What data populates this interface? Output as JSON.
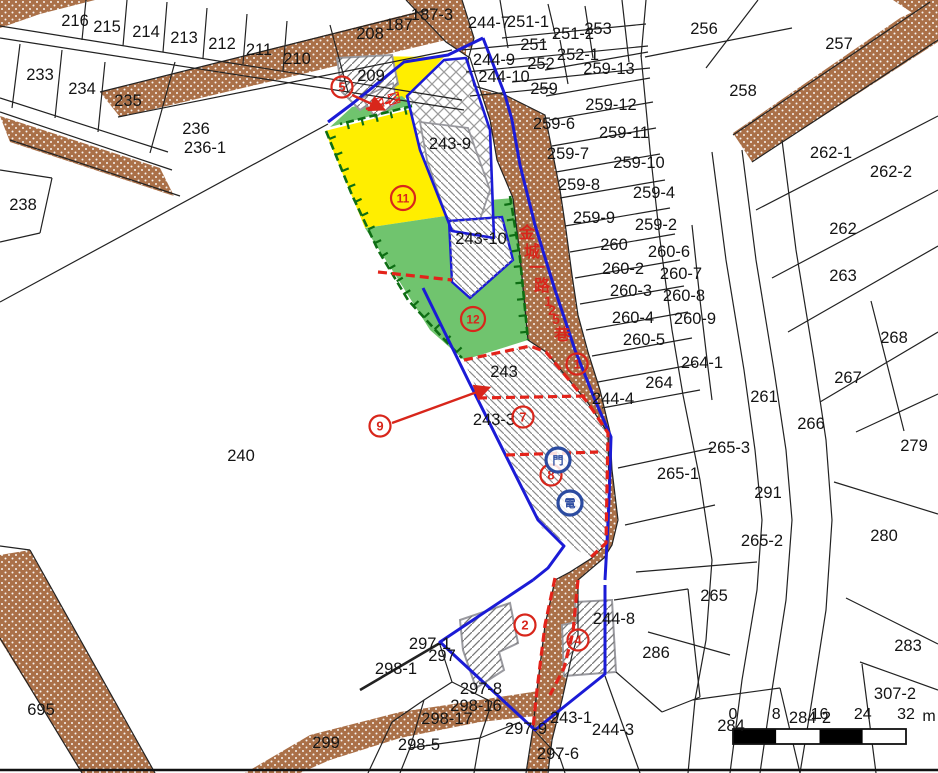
{
  "window": {
    "type": "cadastral-parcel-map"
  },
  "colors": {
    "road_fill": "#aa7048",
    "parcel_line": "#222222",
    "project_boundary_blue": "#1b1bd6",
    "widening_dashed_red": "#e3231a",
    "subsidy_border_green": "#0e6e14",
    "area_yellow": "#ffee00",
    "area_green": "#70c46e",
    "building_outline_gray": "#9a9aa0"
  },
  "map": {
    "parcel_labels": [
      {
        "t": "216",
        "x": 75,
        "y": 20
      },
      {
        "t": "215",
        "x": 107,
        "y": 26
      },
      {
        "t": "214",
        "x": 146,
        "y": 31
      },
      {
        "t": "213",
        "x": 184,
        "y": 37
      },
      {
        "t": "212",
        "x": 222,
        "y": 43
      },
      {
        "t": "211",
        "x": 259,
        "y": 49
      },
      {
        "t": "210",
        "x": 297,
        "y": 58
      },
      {
        "t": "233",
        "x": 40,
        "y": 74
      },
      {
        "t": "234",
        "x": 82,
        "y": 88
      },
      {
        "t": "235",
        "x": 128,
        "y": 100
      },
      {
        "t": "236",
        "x": 196,
        "y": 128
      },
      {
        "t": "236-1",
        "x": 205,
        "y": 147
      },
      {
        "t": "238",
        "x": 23,
        "y": 204
      },
      {
        "t": "240",
        "x": 241,
        "y": 455
      },
      {
        "t": "187-3",
        "x": 432,
        "y": 14
      },
      {
        "t": "187",
        "x": 399,
        "y": 24
      },
      {
        "t": "208",
        "x": 370,
        "y": 33
      },
      {
        "t": "209",
        "x": 371,
        "y": 75
      },
      {
        "t": "244-7",
        "x": 489,
        "y": 22
      },
      {
        "t": "251-1",
        "x": 528,
        "y": 21
      },
      {
        "t": "253",
        "x": 598,
        "y": 28
      },
      {
        "t": "251-2",
        "x": 573,
        "y": 33
      },
      {
        "t": "251",
        "x": 534,
        "y": 44
      },
      {
        "t": "252-1",
        "x": 578,
        "y": 54
      },
      {
        "t": "252",
        "x": 541,
        "y": 63
      },
      {
        "t": "259-13",
        "x": 609,
        "y": 68
      },
      {
        "t": "244-9",
        "x": 494,
        "y": 59
      },
      {
        "t": "244-10",
        "x": 504,
        "y": 76
      },
      {
        "t": "259",
        "x": 544,
        "y": 88
      },
      {
        "t": "256",
        "x": 704,
        "y": 28
      },
      {
        "t": "257",
        "x": 839,
        "y": 43
      },
      {
        "t": "258",
        "x": 743,
        "y": 90
      },
      {
        "t": "259-12",
        "x": 611,
        "y": 104
      },
      {
        "t": "259-6",
        "x": 554,
        "y": 123
      },
      {
        "t": "259-11",
        "x": 624,
        "y": 132
      },
      {
        "t": "259-7",
        "x": 568,
        "y": 153
      },
      {
        "t": "259-10",
        "x": 639,
        "y": 162
      },
      {
        "t": "259-8",
        "x": 579,
        "y": 184
      },
      {
        "t": "259-4",
        "x": 654,
        "y": 192
      },
      {
        "t": "259-9",
        "x": 594,
        "y": 217
      },
      {
        "t": "259-2",
        "x": 656,
        "y": 224
      },
      {
        "t": "260",
        "x": 614,
        "y": 244
      },
      {
        "t": "260-6",
        "x": 669,
        "y": 251
      },
      {
        "t": "260-2",
        "x": 623,
        "y": 268
      },
      {
        "t": "260-7",
        "x": 681,
        "y": 273
      },
      {
        "t": "260-3",
        "x": 631,
        "y": 290
      },
      {
        "t": "260-8",
        "x": 684,
        "y": 295
      },
      {
        "t": "260-4",
        "x": 633,
        "y": 317
      },
      {
        "t": "260-9",
        "x": 695,
        "y": 318
      },
      {
        "t": "260-5",
        "x": 644,
        "y": 339
      },
      {
        "t": "262-1",
        "x": 831,
        "y": 152
      },
      {
        "t": "262-2",
        "x": 891,
        "y": 171
      },
      {
        "t": "262",
        "x": 843,
        "y": 228
      },
      {
        "t": "263",
        "x": 843,
        "y": 275
      },
      {
        "t": "268",
        "x": 894,
        "y": 337
      },
      {
        "t": "267",
        "x": 848,
        "y": 377
      },
      {
        "t": "261",
        "x": 764,
        "y": 396
      },
      {
        "t": "266",
        "x": 811,
        "y": 423
      },
      {
        "t": "279",
        "x": 914,
        "y": 445
      },
      {
        "t": "264-1",
        "x": 702,
        "y": 362
      },
      {
        "t": "264",
        "x": 659,
        "y": 382
      },
      {
        "t": "244-4",
        "x": 613,
        "y": 398
      },
      {
        "t": "265-3",
        "x": 729,
        "y": 447
      },
      {
        "t": "265-1",
        "x": 678,
        "y": 473
      },
      {
        "t": "291",
        "x": 768,
        "y": 492
      },
      {
        "t": "265-2",
        "x": 762,
        "y": 540
      },
      {
        "t": "280",
        "x": 884,
        "y": 535
      },
      {
        "t": "265",
        "x": 714,
        "y": 595
      },
      {
        "t": "283",
        "x": 908,
        "y": 645
      },
      {
        "t": "307-2",
        "x": 895,
        "y": 693
      },
      {
        "t": "284",
        "x": 731,
        "y": 725
      },
      {
        "t": "284-2",
        "x": 810,
        "y": 717
      },
      {
        "t": "286",
        "x": 656,
        "y": 652
      },
      {
        "t": "244-8",
        "x": 614,
        "y": 618
      },
      {
        "t": "243-9",
        "x": 450,
        "y": 143
      },
      {
        "t": "243-10",
        "x": 481,
        "y": 238
      },
      {
        "t": "243",
        "x": 504,
        "y": 371
      },
      {
        "t": "243-3",
        "x": 494,
        "y": 419
      },
      {
        "t": "243-1",
        "x": 571,
        "y": 717
      },
      {
        "t": "244-3",
        "x": 613,
        "y": 729
      },
      {
        "t": "297-1",
        "x": 430,
        "y": 643
      },
      {
        "t": "297",
        "x": 442,
        "y": 655
      },
      {
        "t": "298-1",
        "x": 396,
        "y": 668
      },
      {
        "t": "297-8",
        "x": 481,
        "y": 688
      },
      {
        "t": "298-16",
        "x": 476,
        "y": 705
      },
      {
        "t": "298-17",
        "x": 447,
        "y": 718
      },
      {
        "t": "298-5",
        "x": 419,
        "y": 744
      },
      {
        "t": "297-9",
        "x": 526,
        "y": 728
      },
      {
        "t": "297-6",
        "x": 558,
        "y": 753
      },
      {
        "t": "299",
        "x": 326,
        "y": 742
      },
      {
        "t": "695",
        "x": 41,
        "y": 709
      }
    ],
    "circled_numbers": [
      {
        "n": "5",
        "x": 342,
        "y": 87
      },
      {
        "n": "11",
        "x": 403,
        "y": 198
      },
      {
        "n": "12",
        "x": 473,
        "y": 319
      },
      {
        "n": "9",
        "x": 380,
        "y": 426
      },
      {
        "n": "7",
        "x": 523,
        "y": 417
      },
      {
        "n": "8",
        "x": 551,
        "y": 475
      },
      {
        "n": "1",
        "x": 577,
        "y": 364
      },
      {
        "n": "2",
        "x": 525,
        "y": 625
      },
      {
        "n": "4",
        "x": 578,
        "y": 640
      }
    ],
    "blue_markers": [
      {
        "t": "門",
        "x": 558,
        "y": 460
      },
      {
        "t": "電",
        "x": 570,
        "y": 503
      }
    ],
    "road_label": {
      "text": "金城一路125巷",
      "chars": [
        {
          "c": "金",
          "x": 527,
          "y": 238
        },
        {
          "c": "城",
          "x": 532,
          "y": 257
        },
        {
          "c": "一",
          "x": 537,
          "y": 273
        },
        {
          "c": "路",
          "x": 542,
          "y": 291
        },
        {
          "c": "1",
          "x": 548,
          "y": 306
        },
        {
          "c": "2",
          "x": 552,
          "y": 315
        },
        {
          "c": "5",
          "x": 556,
          "y": 324
        },
        {
          "c": "巷",
          "x": 562,
          "y": 340
        }
      ]
    },
    "scale_bar": {
      "labels": [
        "0",
        "8",
        "16",
        "24",
        "32"
      ],
      "unit": "m"
    }
  }
}
